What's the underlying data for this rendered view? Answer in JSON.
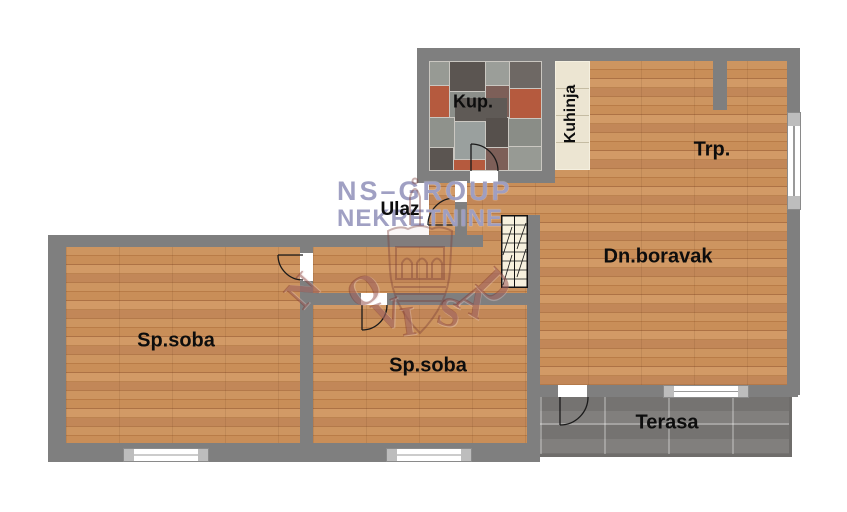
{
  "watermark": {
    "line1": "NS–GROUP",
    "line2": "NEKRETNINE",
    "arc_text": "NOVI SAD"
  },
  "rooms": {
    "kup": {
      "label": "Kup."
    },
    "kuhinja": {
      "label": "Kuhinja"
    },
    "trp": {
      "label": "Trp."
    },
    "ulaz": {
      "label": "Ulaz"
    },
    "dnboravak": {
      "label": "Dn.boravak"
    },
    "spsoba1": {
      "label": "Sp.soba"
    },
    "spsoba2": {
      "label": "Sp.soba"
    },
    "terasa": {
      "label": "Terasa"
    }
  },
  "colors": {
    "wall": "#7f7f7f",
    "wood_floor": "#c78c57",
    "terrace_tile": "#7c7a78",
    "kitchen_counter": "#ece5d2",
    "bath_tile_dark": "#5b5551",
    "bath_tile_terracotta": "#b55a3e",
    "bath_tile_light": "#9b9e99",
    "watermark_purple": "#8f8fb8",
    "watermark_maroon": "#7d302c",
    "label_text": "#0d0d0d"
  }
}
